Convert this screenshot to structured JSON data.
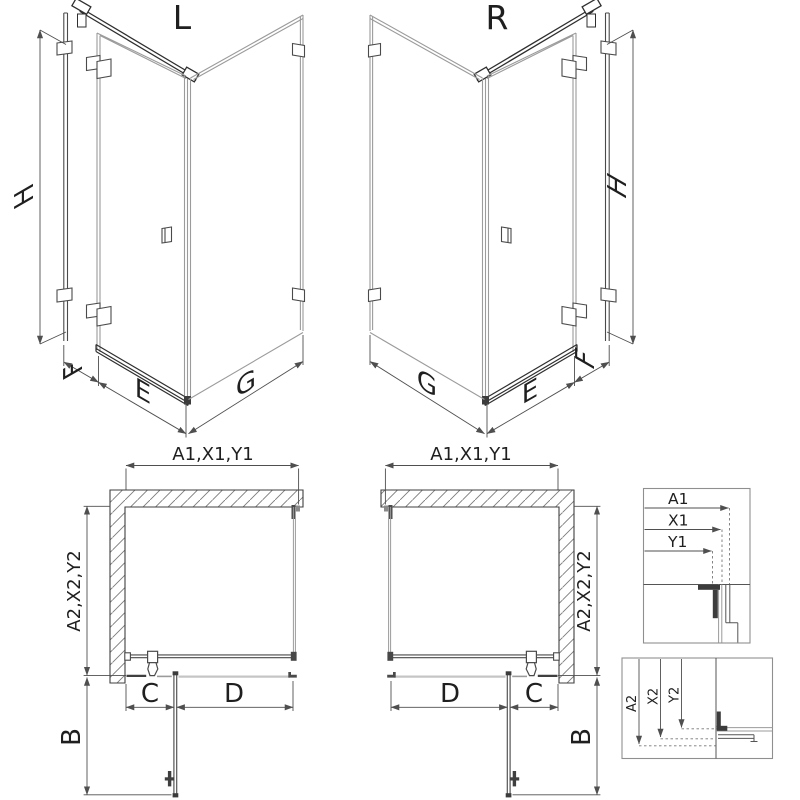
{
  "front_left": {
    "variant": "L",
    "height": "H",
    "wall_offset": "F",
    "door_width": "E",
    "side_panel_width": "G"
  },
  "front_right": {
    "variant": "R",
    "height": "H",
    "wall_offset": "F",
    "door_width": "E",
    "side_panel_width": "G"
  },
  "plan_left": {
    "outer_width": "A1,X1,Y1",
    "outer_depth": "A2,X2,Y2",
    "door_swing": "B",
    "hinge_segment": "C",
    "door_segment": "D"
  },
  "plan_right": {
    "outer_width": "A1,X1,Y1",
    "outer_depth": "A2,X2,Y2",
    "door_swing": "B",
    "hinge_segment": "C",
    "door_segment": "D"
  },
  "detail_width": {
    "a1": "A1",
    "x1": "X1",
    "y1": "Y1"
  },
  "detail_depth": {
    "a2": "A2",
    "x2": "X2",
    "y2": "Y2"
  },
  "colors": {
    "line_dark": "#2f2f2f",
    "profile": "#4a4a4a",
    "glass": "#9b9b9b",
    "tray": "#c5c5c5",
    "dimension": "#4f4f4f",
    "hatch": "#7a7a7a",
    "detail_border": "#8f8f8f",
    "background": "#ffffff"
  }
}
